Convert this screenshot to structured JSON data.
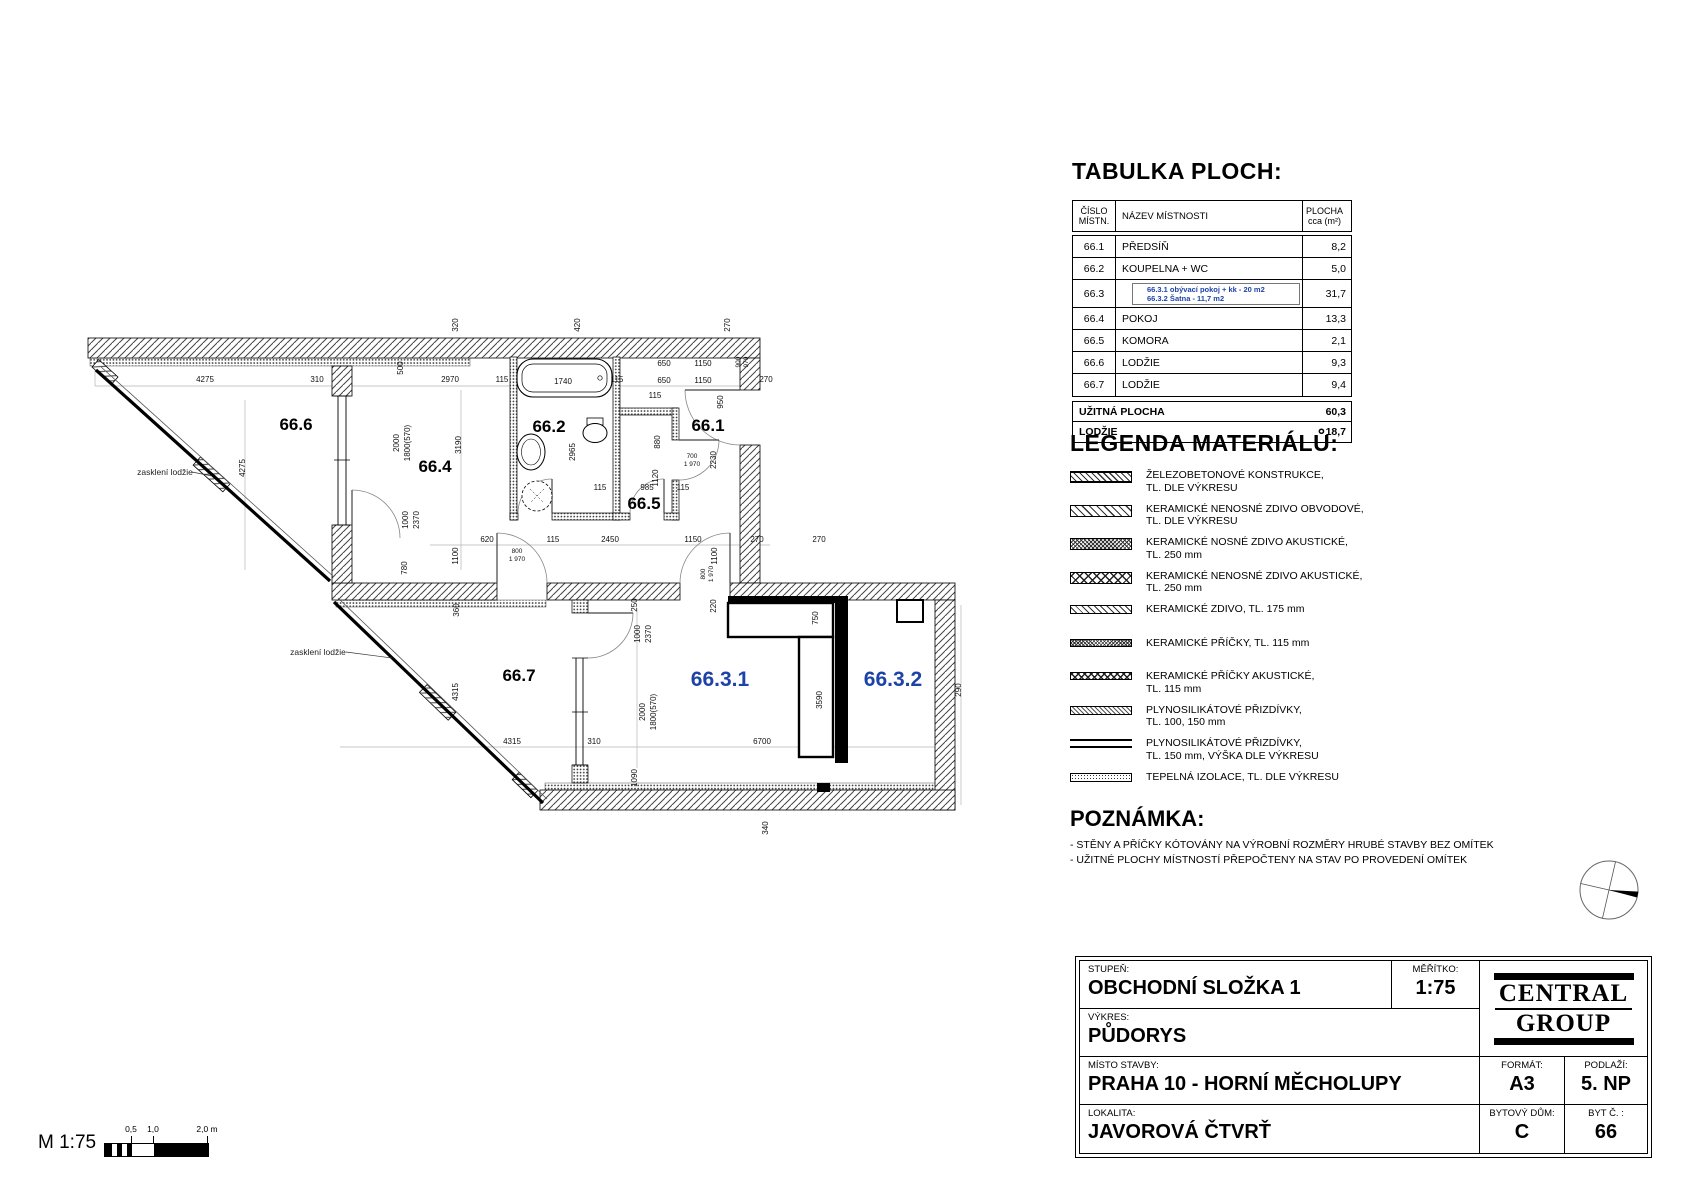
{
  "accent_blue": "#1e43a8",
  "plan": {
    "room_labels": [
      {
        "id": "66.6",
        "x": 296,
        "y": 430,
        "c": "k"
      },
      {
        "id": "66.4",
        "x": 435,
        "y": 472,
        "c": "k"
      },
      {
        "id": "66.2",
        "x": 549,
        "y": 432,
        "c": "k"
      },
      {
        "id": "66.1",
        "x": 708,
        "y": 431,
        "c": "k"
      },
      {
        "id": "66.5",
        "x": 644,
        "y": 509,
        "c": "k"
      },
      {
        "id": "66.7",
        "x": 519,
        "y": 681,
        "c": "k"
      },
      {
        "id": "66.3.1",
        "x": 720,
        "y": 686,
        "c": "b"
      },
      {
        "id": "66.3.2",
        "x": 893,
        "y": 686,
        "c": "b"
      }
    ],
    "annotations": [
      {
        "t": "zasklení lodžie",
        "x": 165,
        "y": 475
      },
      {
        "t": "zasklení lodžie",
        "x": 318,
        "y": 655
      }
    ],
    "dimensions": [
      {
        "t": "4275",
        "x": 205,
        "y": 382
      },
      {
        "t": "310",
        "x": 317,
        "y": 382
      },
      {
        "t": "2970",
        "x": 450,
        "y": 382
      },
      {
        "t": "115",
        "x": 502,
        "y": 382
      },
      {
        "t": "1740",
        "x": 563,
        "y": 384
      },
      {
        "t": "115",
        "x": 617,
        "y": 382
      },
      {
        "t": "650",
        "x": 664,
        "y": 366
      },
      {
        "t": "1150",
        "x": 703,
        "y": 366
      },
      {
        "t": "650",
        "x": 664,
        "y": 383
      },
      {
        "t": "1150",
        "x": 703,
        "y": 383
      },
      {
        "t": "270",
        "x": 766,
        "y": 382
      },
      {
        "t": "320",
        "x": 458,
        "y": 325,
        "r": 1
      },
      {
        "t": "420",
        "x": 580,
        "y": 325,
        "r": 1
      },
      {
        "t": "270",
        "x": 730,
        "y": 325,
        "r": 1
      },
      {
        "t": "900",
        "x": 740,
        "y": 362,
        "r": 1,
        "s": 1
      },
      {
        "t": "970",
        "x": 748,
        "y": 362,
        "r": 1,
        "s": 1
      },
      {
        "t": "500",
        "x": 403,
        "y": 368,
        "r": 1
      },
      {
        "t": "2000",
        "x": 399,
        "y": 443,
        "r": 1
      },
      {
        "t": "1800(570)",
        "x": 410,
        "y": 443,
        "r": 1
      },
      {
        "t": "3190",
        "x": 461,
        "y": 445,
        "r": 1
      },
      {
        "t": "2965",
        "x": 575,
        "y": 452,
        "r": 1
      },
      {
        "t": "880",
        "x": 660,
        "y": 442,
        "r": 1
      },
      {
        "t": "950",
        "x": 723,
        "y": 402,
        "r": 1
      },
      {
        "t": "115",
        "x": 655,
        "y": 398
      },
      {
        "t": "700",
        "x": 692,
        "y": 458,
        "s": 1
      },
      {
        "t": "1 970",
        "x": 692,
        "y": 466,
        "s": 1
      },
      {
        "t": "1120",
        "x": 658,
        "y": 478,
        "r": 1
      },
      {
        "t": "2230",
        "x": 716,
        "y": 460,
        "r": 1
      },
      {
        "t": "115",
        "x": 600,
        "y": 490
      },
      {
        "t": "985",
        "x": 647,
        "y": 490
      },
      {
        "t": "115",
        "x": 683,
        "y": 490
      },
      {
        "t": "620",
        "x": 487,
        "y": 542
      },
      {
        "t": "115",
        "x": 553,
        "y": 542
      },
      {
        "t": "2450",
        "x": 610,
        "y": 542
      },
      {
        "t": "1150",
        "x": 693,
        "y": 542
      },
      {
        "t": "270",
        "x": 757,
        "y": 542
      },
      {
        "t": "270",
        "x": 819,
        "y": 542
      },
      {
        "t": "800",
        "x": 517,
        "y": 553,
        "s": 1
      },
      {
        "t": "1 970",
        "x": 517,
        "y": 561,
        "s": 1
      },
      {
        "t": "1100",
        "x": 458,
        "y": 556,
        "r": 1
      },
      {
        "t": "1100",
        "x": 717,
        "y": 556,
        "r": 1
      },
      {
        "t": "800",
        "x": 705,
        "y": 574,
        "r": 1,
        "s": 1
      },
      {
        "t": "1 970",
        "x": 713,
        "y": 574,
        "r": 1,
        "s": 1
      },
      {
        "t": "780",
        "x": 407,
        "y": 568,
        "r": 1
      },
      {
        "t": "1000",
        "x": 408,
        "y": 520,
        "r": 1
      },
      {
        "t": "2370",
        "x": 419,
        "y": 520,
        "r": 1
      },
      {
        "t": "4275",
        "x": 245,
        "y": 468,
        "r": 1
      },
      {
        "t": "250",
        "x": 637,
        "y": 605,
        "r": 1
      },
      {
        "t": "220",
        "x": 716,
        "y": 606,
        "r": 1
      },
      {
        "t": "750",
        "x": 818,
        "y": 618,
        "r": 1
      },
      {
        "t": "360",
        "x": 459,
        "y": 610,
        "r": 1
      },
      {
        "t": "4315",
        "x": 458,
        "y": 692,
        "r": 1
      },
      {
        "t": "1000",
        "x": 640,
        "y": 634,
        "r": 1
      },
      {
        "t": "2370",
        "x": 651,
        "y": 634,
        "r": 1
      },
      {
        "t": "2000",
        "x": 645,
        "y": 712,
        "r": 1
      },
      {
        "t": "1800(570)",
        "x": 656,
        "y": 712,
        "r": 1
      },
      {
        "t": "3590",
        "x": 822,
        "y": 700,
        "r": 1
      },
      {
        "t": "4315",
        "x": 512,
        "y": 744
      },
      {
        "t": "310",
        "x": 594,
        "y": 744
      },
      {
        "t": "6700",
        "x": 762,
        "y": 744
      },
      {
        "t": "290",
        "x": 961,
        "y": 690,
        "r": 1
      },
      {
        "t": "1090",
        "x": 637,
        "y": 778,
        "r": 1
      },
      {
        "t": "340",
        "x": 768,
        "y": 828,
        "r": 1
      }
    ]
  },
  "areas_table": {
    "title": "TABULKA PLOCH:",
    "headers": {
      "no1": "ČÍSLO",
      "no2": "MÍSTN.",
      "name": "NÁZEV MÍSTNOSTI",
      "area1": "PLOCHA",
      "area2": "cca (m²)"
    },
    "rows": [
      {
        "no": "66.1",
        "name": "PŘEDSÍŇ",
        "area": "8,2"
      },
      {
        "no": "66.2",
        "name": "KOUPELNA + WC",
        "area": "5,0"
      },
      {
        "no": "66.3",
        "name": "",
        "area": "31,7",
        "sub": [
          "66.3.1 obývací pokoj + kk - 20 m2",
          "66.3.2 Šatna - 11,7 m2"
        ]
      },
      {
        "no": "66.4",
        "name": "POKOJ",
        "area": "13,3"
      },
      {
        "no": "66.5",
        "name": "KOMORA",
        "area": "2,1"
      },
      {
        "no": "66.6",
        "name": "LODŽIE",
        "area": "9,3"
      },
      {
        "no": "66.7",
        "name": "LODŽIE",
        "area": "9,4"
      }
    ],
    "totals": [
      {
        "name": "UŽITNÁ PLOCHA",
        "area": "60,3"
      },
      {
        "name": "LODŽIE",
        "area": "18,7"
      }
    ]
  },
  "legend": {
    "title": "LEGENDA MATERIÁLŮ:",
    "items": [
      {
        "pattern": "sw-rc",
        "lines": "ŽELEZOBETONOVÉ KONSTRUKCE,\nTL. DLE VÝKRESU"
      },
      {
        "pattern": "sw-hatch",
        "lines": "KERAMICKÉ NENOSNÉ ZDIVO OBVODOVÉ,\nTL. DLE VÝKRESU"
      },
      {
        "pattern": "sw-mesh",
        "lines": "KERAMICKÉ NOSNÉ ZDIVO AKUSTICKÉ,\nTL. 250 mm"
      },
      {
        "pattern": "sw-xx",
        "lines": "KERAMICKÉ NENOSNÉ ZDIVO AKUSTICKÉ,\nTL. 250 mm"
      },
      {
        "pattern": "sw-hatch-thin",
        "lines": "KERAMICKÉ ZDIVO, TL. 175 mm"
      },
      {
        "pattern": "sw-mesh-thin",
        "lines": "KERAMICKÉ PŘÍČKY, TL. 115 mm"
      },
      {
        "pattern": "sw-xx-thin",
        "lines": "KERAMICKÉ PŘÍČKY AKUSTICKÉ,\nTL. 115 mm"
      },
      {
        "pattern": "sw-fine",
        "lines": "PLYNOSILIKÁTOVÉ PŘIZDÍVKY,\nTL. 100, 150 mm"
      },
      {
        "pattern": "sw-lines",
        "lines": "PLYNOSILIKÁTOVÉ PŘIZDÍVKY,\nTL. 150 mm, VÝŠKA DLE VÝKRESU"
      },
      {
        "pattern": "sw-dots",
        "lines": "TEPELNÁ IZOLACE, TL. DLE VÝKRESU"
      }
    ]
  },
  "note": {
    "title": "POZNÁMKA:",
    "lines": [
      "- STĚNY A PŘÍČKY KÓTOVÁNY NA VÝROBNÍ ROZMĚRY HRUBÉ STAVBY BEZ OMÍTEK",
      "- UŽITNÉ PLOCHY MÍSTNOSTÍ PŘEPOČTENY NA STAV PO PROVEDENÍ OMÍTEK"
    ]
  },
  "title_block": {
    "stupen_label": "STUPEŇ:",
    "stupen": "OBCHODNÍ SLOŽKA 1",
    "meritko_label": "MĚŘÍTKO:",
    "meritko": "1:75",
    "vykres_label": "VÝKRES:",
    "vykres": "PŮDORYS",
    "misto_label": "MÍSTO STAVBY:",
    "misto": "PRAHA 10 - HORNÍ MĚCHOLUPY",
    "format_label": "FORMÁT:",
    "format": "A3",
    "podlazi_label": "PODLAŽÍ:",
    "podlazi": "5. NP",
    "lokalita_label": "LOKALITA:",
    "lokalita": "JAVOROVÁ ČTVRŤ",
    "dum_label": "BYTOVÝ DŮM:",
    "dum": "C",
    "byt_label": "BYT Č. :",
    "byt": "66",
    "logo_line1": "CENTRAL",
    "logo_line2": "GROUP"
  },
  "scale_bar": {
    "label": "M 1:75",
    "ticks": [
      {
        "t": "0,5",
        "x": 93
      },
      {
        "t": "1,0",
        "x": 115
      },
      {
        "t": "2,0 m",
        "x": 169
      }
    ]
  }
}
